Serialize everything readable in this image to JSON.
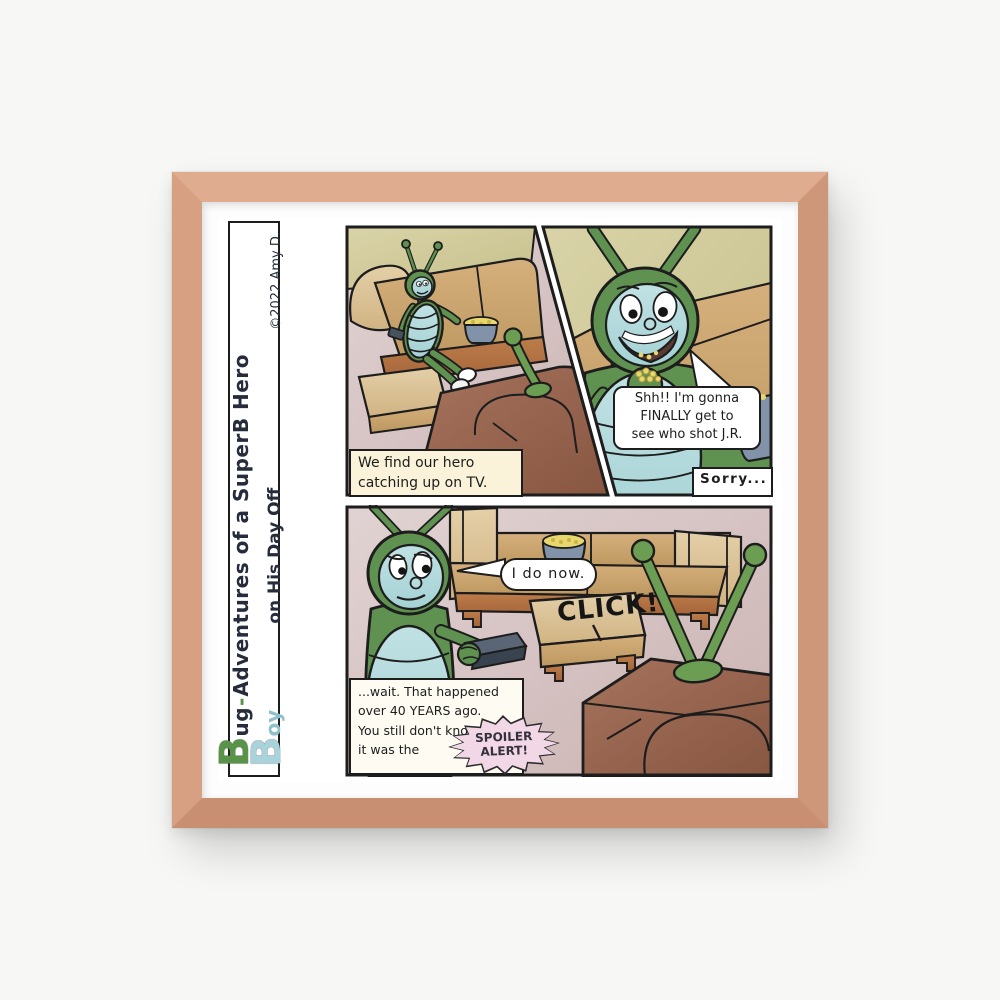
{
  "artwork": {
    "title": {
      "bug_initial": "B",
      "bug_rest": "ug",
      "hyphen": "-",
      "series": "Adventures of a SuperB Hero",
      "boy_initial": "B",
      "boy_rest": "oy",
      "subtitle": "on His Day Off",
      "credit": "©2022 Amy D."
    },
    "panel1": {
      "caption_line1": "We find our hero",
      "caption_line2": "catching up on TV."
    },
    "panel2": {
      "speech_line1": "Shh!! I'm gonna",
      "speech_line2": "FINALLY get to",
      "speech_line3": "see who shot J.R.",
      "caption": "Sorry..."
    },
    "panel3": {
      "speech": "I do now.",
      "sfx": "CLICK!",
      "caption_line1": "...wait. That happened",
      "caption_line2": "over 40 YEARS ago.",
      "caption_line3": "You still don't know",
      "caption_line4": "it was the",
      "spoiler_line1": "SPOILER",
      "spoiler_line2": "ALERT!"
    }
  },
  "palette": {
    "frame_wood": "#d9a084",
    "mat": "#fdfdfd",
    "page": "#ffffff",
    "ink": "#1d1d1d",
    "wall_mauve": "#d7c3c3",
    "wall_khaki": "#d0ca9c",
    "couch_tan": "#cda671",
    "couch_light": "#dcc49c",
    "wood_trim": "#b5773f",
    "tv_brown": "#9a6852",
    "bug_green": "#5f9150",
    "bug_belly": "#b7dcde",
    "bowl_blue": "#8292a8",
    "popcorn_yellow": "#e8d76d",
    "remote_dark": "#47525f",
    "spoiler_pink": "#f2d7e6",
    "title_green": "#589347",
    "title_blue": "#a9d3da"
  }
}
